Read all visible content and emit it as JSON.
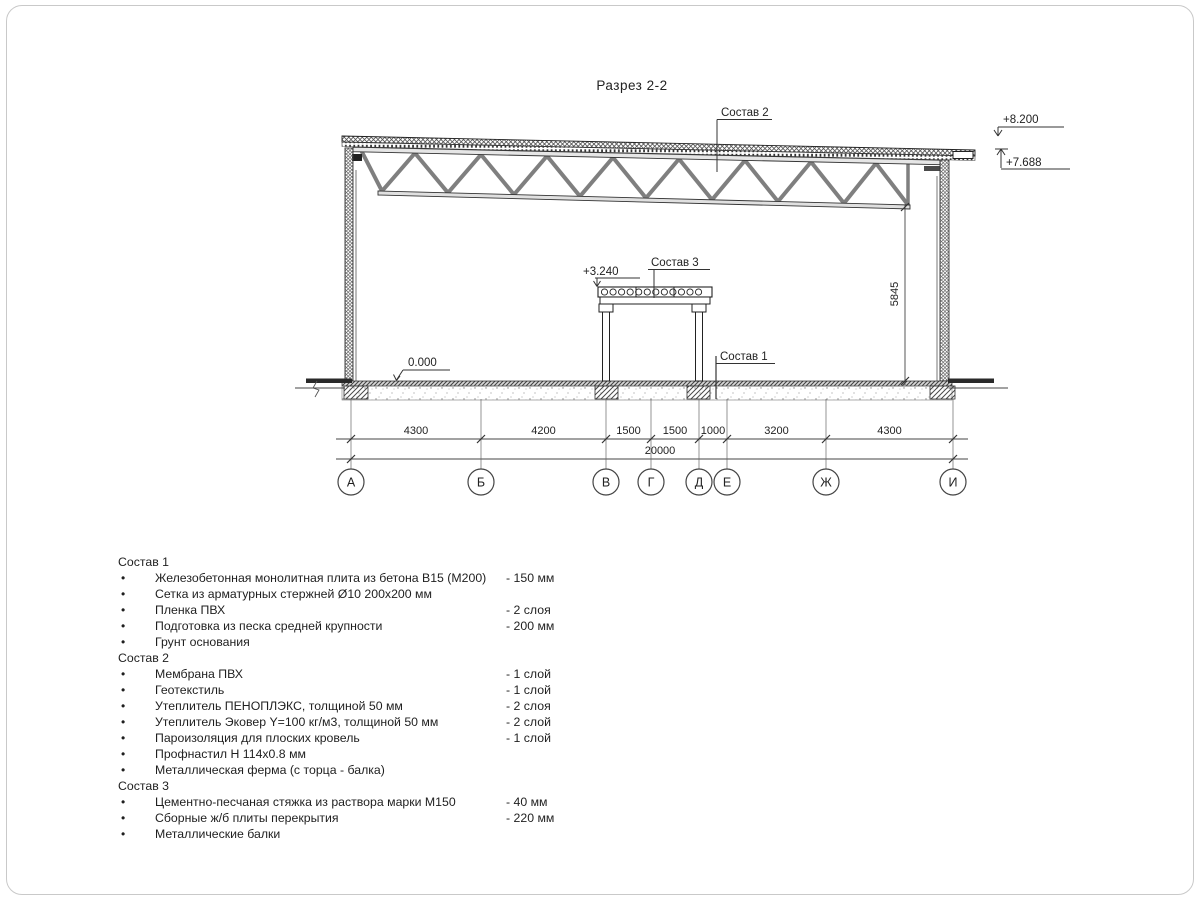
{
  "page": {
    "title": "Разрез 2-2"
  },
  "drawing": {
    "labels": {
      "sostav1": "Состав 1",
      "sostav2": "Состав 2",
      "sostav3": "Состав 3"
    },
    "levels": {
      "roof_top": "+8.200",
      "roof_edge": "+7.688",
      "mezzanine": "+3.240",
      "floor": "0.000"
    },
    "dims": {
      "segments": [
        "4300",
        "4200",
        "1500",
        "1500",
        "1000",
        "3200",
        "4300"
      ],
      "total": "20000",
      "height": "5845"
    },
    "axes": [
      "А",
      "Б",
      "В",
      "Г",
      "Д",
      "Е",
      "Ж",
      "И"
    ]
  },
  "notes": {
    "sections": [
      {
        "header": "Состав 1",
        "items": [
          {
            "text": "Железобетонная монолитная плита из бетона В15 (М200)",
            "value": "-  150 мм"
          },
          {
            "text": "Сетка из арматурных стержней Ø10 200х200 мм",
            "value": ""
          },
          {
            "text": "Пленка ПВХ",
            "value": "-  2 слоя"
          },
          {
            "text": "Подготовка из песка средней крупности",
            "value": "- 200 мм"
          },
          {
            "text": "Грунт основания",
            "value": ""
          }
        ]
      },
      {
        "header": "Состав 2",
        "items": [
          {
            "text": "Мембрана ПВХ",
            "value": "- 1 слой"
          },
          {
            "text": "Геотекстиль",
            "value": "- 1 слой"
          },
          {
            "text": "Утеплитель ПЕНОПЛЭКС, толщиной 50 мм",
            "value": "- 2 слоя"
          },
          {
            "text": "Утеплитель Эковер Y=100 кг/м3, толщиной 50 мм",
            "value": "- 2 слой"
          },
          {
            "text": "Пароизоляция для плоских кровель",
            "value": "- 1 слой"
          },
          {
            "text": "Профнастил Н 114х0.8 мм",
            "value": ""
          },
          {
            "text": "Металлическая ферма (с торца - балка)",
            "value": ""
          }
        ]
      },
      {
        "header": "Состав 3",
        "items": [
          {
            "text": "Цементно-песчаная стяжка из раствора марки М150",
            "value": "-  40 мм"
          },
          {
            "text": "Сборные ж/б плиты перекрытия",
            "value": "- 220 мм"
          },
          {
            "text": "Металлические балки",
            "value": ""
          }
        ]
      }
    ]
  }
}
